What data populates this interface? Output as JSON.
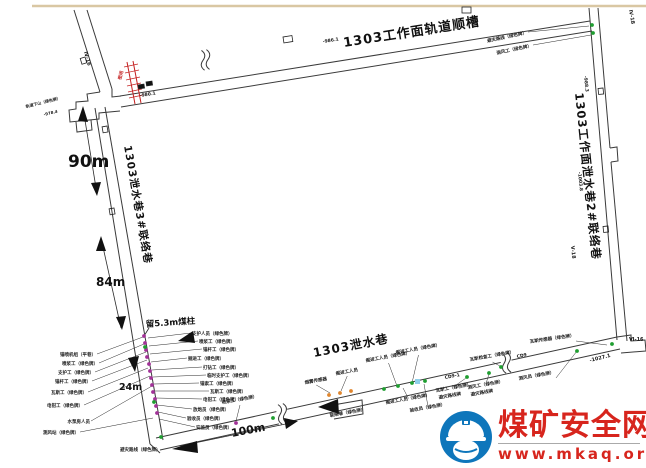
{
  "page": {
    "background": "#ffffff",
    "top_border_color": "#d9c7a3"
  },
  "watermark": {
    "site_name": "煤矿安全网",
    "site_url": "www.mkaq.org",
    "brand_red": "#d7251d",
    "brand_blue": "#0e76bb"
  },
  "diagram": {
    "tunnel_names": {
      "top": "1303工作面轨道顺槽",
      "right": "1303工作面泄水巷2#联络巷",
      "left": "1303泄水巷3#联络巷",
      "bottom": "1303泄水巷"
    },
    "dimensions": {
      "d90": "90m",
      "d84": "84m",
      "d24": "24m",
      "d100": "100m",
      "pillar": "留5.3m煤柱"
    },
    "colors": {
      "m": "#a23298",
      "g": "#1f9e30",
      "o": "#e0862e",
      "c": "#8fd0ea",
      "ink": "#1a1a1a",
      "seal_red": "#c42020"
    },
    "labels": [
      {
        "t": "避灾路线（绿色牌）",
        "x": 527,
        "y": 34,
        "a": "end",
        "r": -12,
        "lf": "e",
        "tx": 589,
        "ty": 26
      },
      {
        "t": "测风工（绿色牌）",
        "x": 532,
        "y": 47,
        "a": "end",
        "r": -12,
        "lf": "e",
        "tx": 591,
        "ty": 35
      },
      {
        "t": "Ⅳ-18",
        "x": 629,
        "y": 10,
        "s": 5,
        "r": 80
      },
      {
        "t": "Ⅳ-16",
        "x": 84,
        "y": 52,
        "s": 5,
        "r": 75
      },
      {
        "t": "-988.3",
        "x": 584,
        "y": 76,
        "s": 4.5,
        "r": 84
      },
      {
        "t": "-1003.8",
        "x": 578,
        "y": 172,
        "s": 4.5,
        "r": 84
      },
      {
        "t": "Ⅴ-18",
        "x": 571,
        "y": 246,
        "s": 5,
        "r": 84
      },
      {
        "t": "-986.1",
        "x": 323,
        "y": 43,
        "s": 4.5,
        "r": -9
      },
      {
        "t": "-980.1",
        "x": 140,
        "y": 97,
        "s": 4.5,
        "r": -9
      },
      {
        "t": "密闭",
        "x": 121,
        "y": 80,
        "s": 4.5,
        "r": -75,
        "c": "#c42020"
      },
      {
        "t": "轨道下山（绿色牌）",
        "x": 26,
        "y": 108,
        "s": 4,
        "r": -14
      },
      {
        "t": "-978.4",
        "x": 44,
        "y": 116,
        "s": 4,
        "r": -14
      },
      {
        "t": "锚喷机组（平巷）",
        "x": 96,
        "y": 356,
        "a": "end",
        "lf": "e",
        "tx": 143,
        "ty": 337
      },
      {
        "t": "喷浆工（绿色牌）",
        "x": 98,
        "y": 365,
        "a": "end",
        "lf": "e",
        "tx": 144,
        "ty": 344
      },
      {
        "t": "支护工（绿色牌）",
        "x": 94,
        "y": 374,
        "a": "end",
        "lf": "e",
        "tx": 146,
        "ty": 352
      },
      {
        "t": "锚杆工（绿色牌）",
        "x": 91,
        "y": 383,
        "a": "end",
        "lf": "e",
        "tx": 147,
        "ty": 360
      },
      {
        "t": "瓦斯工（绿色牌）",
        "x": 87,
        "y": 394,
        "a": "end",
        "lf": "e",
        "tx": 148,
        "ty": 368
      },
      {
        "t": "电钳工（绿色牌）",
        "x": 83,
        "y": 407,
        "a": "end",
        "lf": "e",
        "tx": 150,
        "ty": 376
      },
      {
        "t": "水泵房人员",
        "x": 90,
        "y": 423,
        "a": "end",
        "lf": "e",
        "tx": 152,
        "ty": 386
      },
      {
        "t": "测风站（绿色牌）",
        "x": 79,
        "y": 434,
        "a": "end",
        "lf": "e",
        "tx": 153,
        "ty": 418
      },
      {
        "t": "避灾路线（绿色牌）",
        "x": 120,
        "y": 451,
        "a": "start",
        "s": 4.5
      },
      {
        "t": "支护人员（绿色牌）",
        "x": 192,
        "y": 335,
        "a": "start",
        "lf": "s",
        "tx": 148,
        "ty": 338
      },
      {
        "t": "喷浆工（绿色牌）",
        "x": 199,
        "y": 343,
        "a": "start",
        "lf": "s",
        "tx": 149,
        "ty": 346
      },
      {
        "t": "锚杆工（绿色牌）",
        "x": 203,
        "y": 351,
        "a": "start",
        "lf": "s",
        "tx": 150,
        "ty": 354
      },
      {
        "t": "掘进工（绿色牌）",
        "x": 188,
        "y": 360,
        "a": "start",
        "lf": "s",
        "tx": 151,
        "ty": 362
      },
      {
        "t": "打钻工（绿色牌）",
        "x": 203,
        "y": 369,
        "a": "start",
        "lf": "s",
        "tx": 152,
        "ty": 370
      },
      {
        "t": "临时支护工（绿色牌）",
        "x": 207,
        "y": 377,
        "a": "start",
        "lf": "s",
        "tx": 153,
        "ty": 377
      },
      {
        "t": "锚索工（绿色牌）",
        "x": 200,
        "y": 385,
        "a": "start",
        "lf": "s",
        "tx": 154,
        "ty": 384
      },
      {
        "t": "瓦斯工（绿色牌）",
        "x": 210,
        "y": 393,
        "a": "start",
        "lf": "s",
        "tx": 155,
        "ty": 391
      },
      {
        "t": "电钳工（绿色牌）",
        "x": 203,
        "y": 401,
        "a": "start",
        "lf": "s",
        "tx": 156,
        "ty": 398
      },
      {
        "t": "放炮员（绿色牌）",
        "x": 193,
        "y": 411,
        "a": "start",
        "lf": "s",
        "tx": 157,
        "ty": 405
      },
      {
        "t": "验收员（绿色牌）",
        "x": 187,
        "y": 420,
        "a": "start",
        "lf": "s",
        "tx": 158,
        "ty": 412
      },
      {
        "t": "安监员（绿色牌）",
        "x": 196,
        "y": 429,
        "a": "start",
        "lf": "s",
        "tx": 159,
        "ty": 419
      },
      {
        "t": "喷浆工（绿色牌）",
        "x": 222,
        "y": 404,
        "a": "start",
        "r": -10,
        "lf": "b",
        "tx": 236,
        "ty": 421
      },
      {
        "t": "烟雾传感器",
        "x": 305,
        "y": 384,
        "a": "start",
        "r": -10,
        "lf": "b",
        "tx": 330,
        "ty": 393
      },
      {
        "t": "掘进工人员",
        "x": 336,
        "y": 375,
        "a": "start",
        "r": -10,
        "lf": "b",
        "tx": 341,
        "ty": 391
      },
      {
        "t": "掘进工人员（绿色牌）",
        "x": 366,
        "y": 362,
        "a": "start",
        "r": -10,
        "lf": "b",
        "tx": 397,
        "ty": 386
      },
      {
        "t": "掘进工人员（绿色牌）",
        "x": 396,
        "y": 354,
        "a": "start",
        "r": -10,
        "lf": "b",
        "tx": 412,
        "ty": 383
      },
      {
        "t": "瓦斯检查工（绿色牌）",
        "x": 470,
        "y": 361,
        "a": "start",
        "r": -10,
        "lf": "b",
        "tx": 500,
        "ty": 366
      },
      {
        "t": "掘进工人员（绿色牌）",
        "x": 386,
        "y": 404,
        "a": "start",
        "r": -10,
        "lf": "a",
        "tx": 403,
        "ty": 388
      },
      {
        "t": "验收员（绿色牌）",
        "x": 410,
        "y": 412,
        "a": "start",
        "r": -10,
        "lf": "a",
        "tx": 424,
        "ty": 384
      },
      {
        "t": "瓦斯工（绿色牌）",
        "x": 436,
        "y": 392,
        "a": "start",
        "r": -10,
        "lf": "a",
        "tx": 466,
        "ty": 378
      },
      {
        "t": "避灾路线牌",
        "x": 439,
        "y": 399,
        "a": "start",
        "r": -10
      },
      {
        "t": "测风工（绿色牌）",
        "x": 468,
        "y": 389,
        "a": "start",
        "r": -10,
        "lf": "a",
        "tx": 489,
        "ty": 374
      },
      {
        "t": "避灾路线牌",
        "x": 471,
        "y": 396,
        "a": "start",
        "r": -10
      },
      {
        "t": "测风员（绿色牌）",
        "x": 519,
        "y": 380,
        "a": "start",
        "r": -10,
        "lf": "e",
        "tx": 577,
        "ty": 351
      },
      {
        "t": "瓦斯传感器（绿色牌）",
        "x": 530,
        "y": 343,
        "a": "start",
        "r": -8,
        "lf": "e",
        "tx": 607,
        "ty": 345
      },
      {
        "t": "Ⅵ-16",
        "x": 629,
        "y": 341,
        "s": 5
      },
      {
        "t": "-1027.1",
        "x": 590,
        "y": 362,
        "s": 5,
        "r": -14
      },
      {
        "t": "CD9",
        "x": 517,
        "y": 358,
        "s": 4.5,
        "r": -11
      },
      {
        "t": "CD9-1",
        "x": 445,
        "y": 379,
        "s": 4.5,
        "r": -11
      },
      {
        "t": "联络巷（绿色牌）",
        "x": 330,
        "y": 417,
        "a": "start",
        "r": -10,
        "s": 4.5
      }
    ],
    "dots": [
      [
        "m",
        144,
        336
      ],
      [
        "m",
        145,
        343
      ],
      [
        "m",
        146,
        350
      ],
      [
        "m",
        147,
        357
      ],
      [
        "m",
        149,
        364
      ],
      [
        "m",
        150,
        371
      ],
      [
        "m",
        151,
        378
      ],
      [
        "m",
        152,
        385
      ],
      [
        "m",
        153,
        392
      ],
      [
        "m",
        155,
        399
      ],
      [
        "m",
        156,
        406
      ],
      [
        "m",
        157,
        413
      ],
      [
        "m",
        236,
        423
      ],
      [
        "g",
        145,
        347
      ],
      [
        "g",
        154,
        402
      ],
      [
        "g",
        161,
        437
      ],
      [
        "g",
        273,
        418
      ],
      [
        "g",
        384,
        389
      ],
      [
        "g",
        398,
        386
      ],
      [
        "g",
        412,
        383
      ],
      [
        "g",
        425,
        381
      ],
      [
        "g",
        467,
        377
      ],
      [
        "g",
        489,
        373
      ],
      [
        "g",
        501,
        367
      ],
      [
        "g",
        577,
        351
      ],
      [
        "g",
        612,
        344
      ],
      [
        "g",
        592,
        25
      ],
      [
        "g",
        593,
        33
      ],
      [
        "o",
        329,
        395
      ],
      [
        "o",
        340,
        393
      ],
      [
        "o",
        351,
        391
      ]
    ],
    "symbols": [
      [
        283,
        37,
        9,
        6,
        -9,
        0
      ],
      [
        462,
        7,
        9,
        6,
        0,
        0
      ],
      [
        85,
        57,
        6,
        5,
        73,
        0
      ],
      [
        138,
        85,
        6,
        4,
        -9,
        1
      ],
      [
        146,
        82,
        6,
        4,
        -9,
        1
      ],
      [
        107,
        126,
        6,
        5,
        80,
        0
      ],
      [
        114,
        208,
        6,
        5,
        80,
        0
      ],
      [
        603,
        88,
        6,
        5,
        84,
        0
      ],
      [
        608,
        226,
        6,
        5,
        84,
        0
      ],
      [
        415,
        379,
        5,
        5,
        0,
        2
      ]
    ],
    "triangles": [
      "83,106 78,121 88,122",
      "97,196 91,183 101,182",
      "101,236 96,251 106,251",
      "122,330 116,317 126,316",
      "172,449 197,441 198,453",
      "298,421 284,418 286,429",
      "318,407 338,399 339,414",
      "128,358 139,356 135,372",
      "178,341 193,331 195,343"
    ],
    "breaks": [
      [
        205,
        60,
        -9
      ],
      [
        282,
        414,
        -12
      ],
      [
        506,
        363,
        -12
      ]
    ]
  }
}
